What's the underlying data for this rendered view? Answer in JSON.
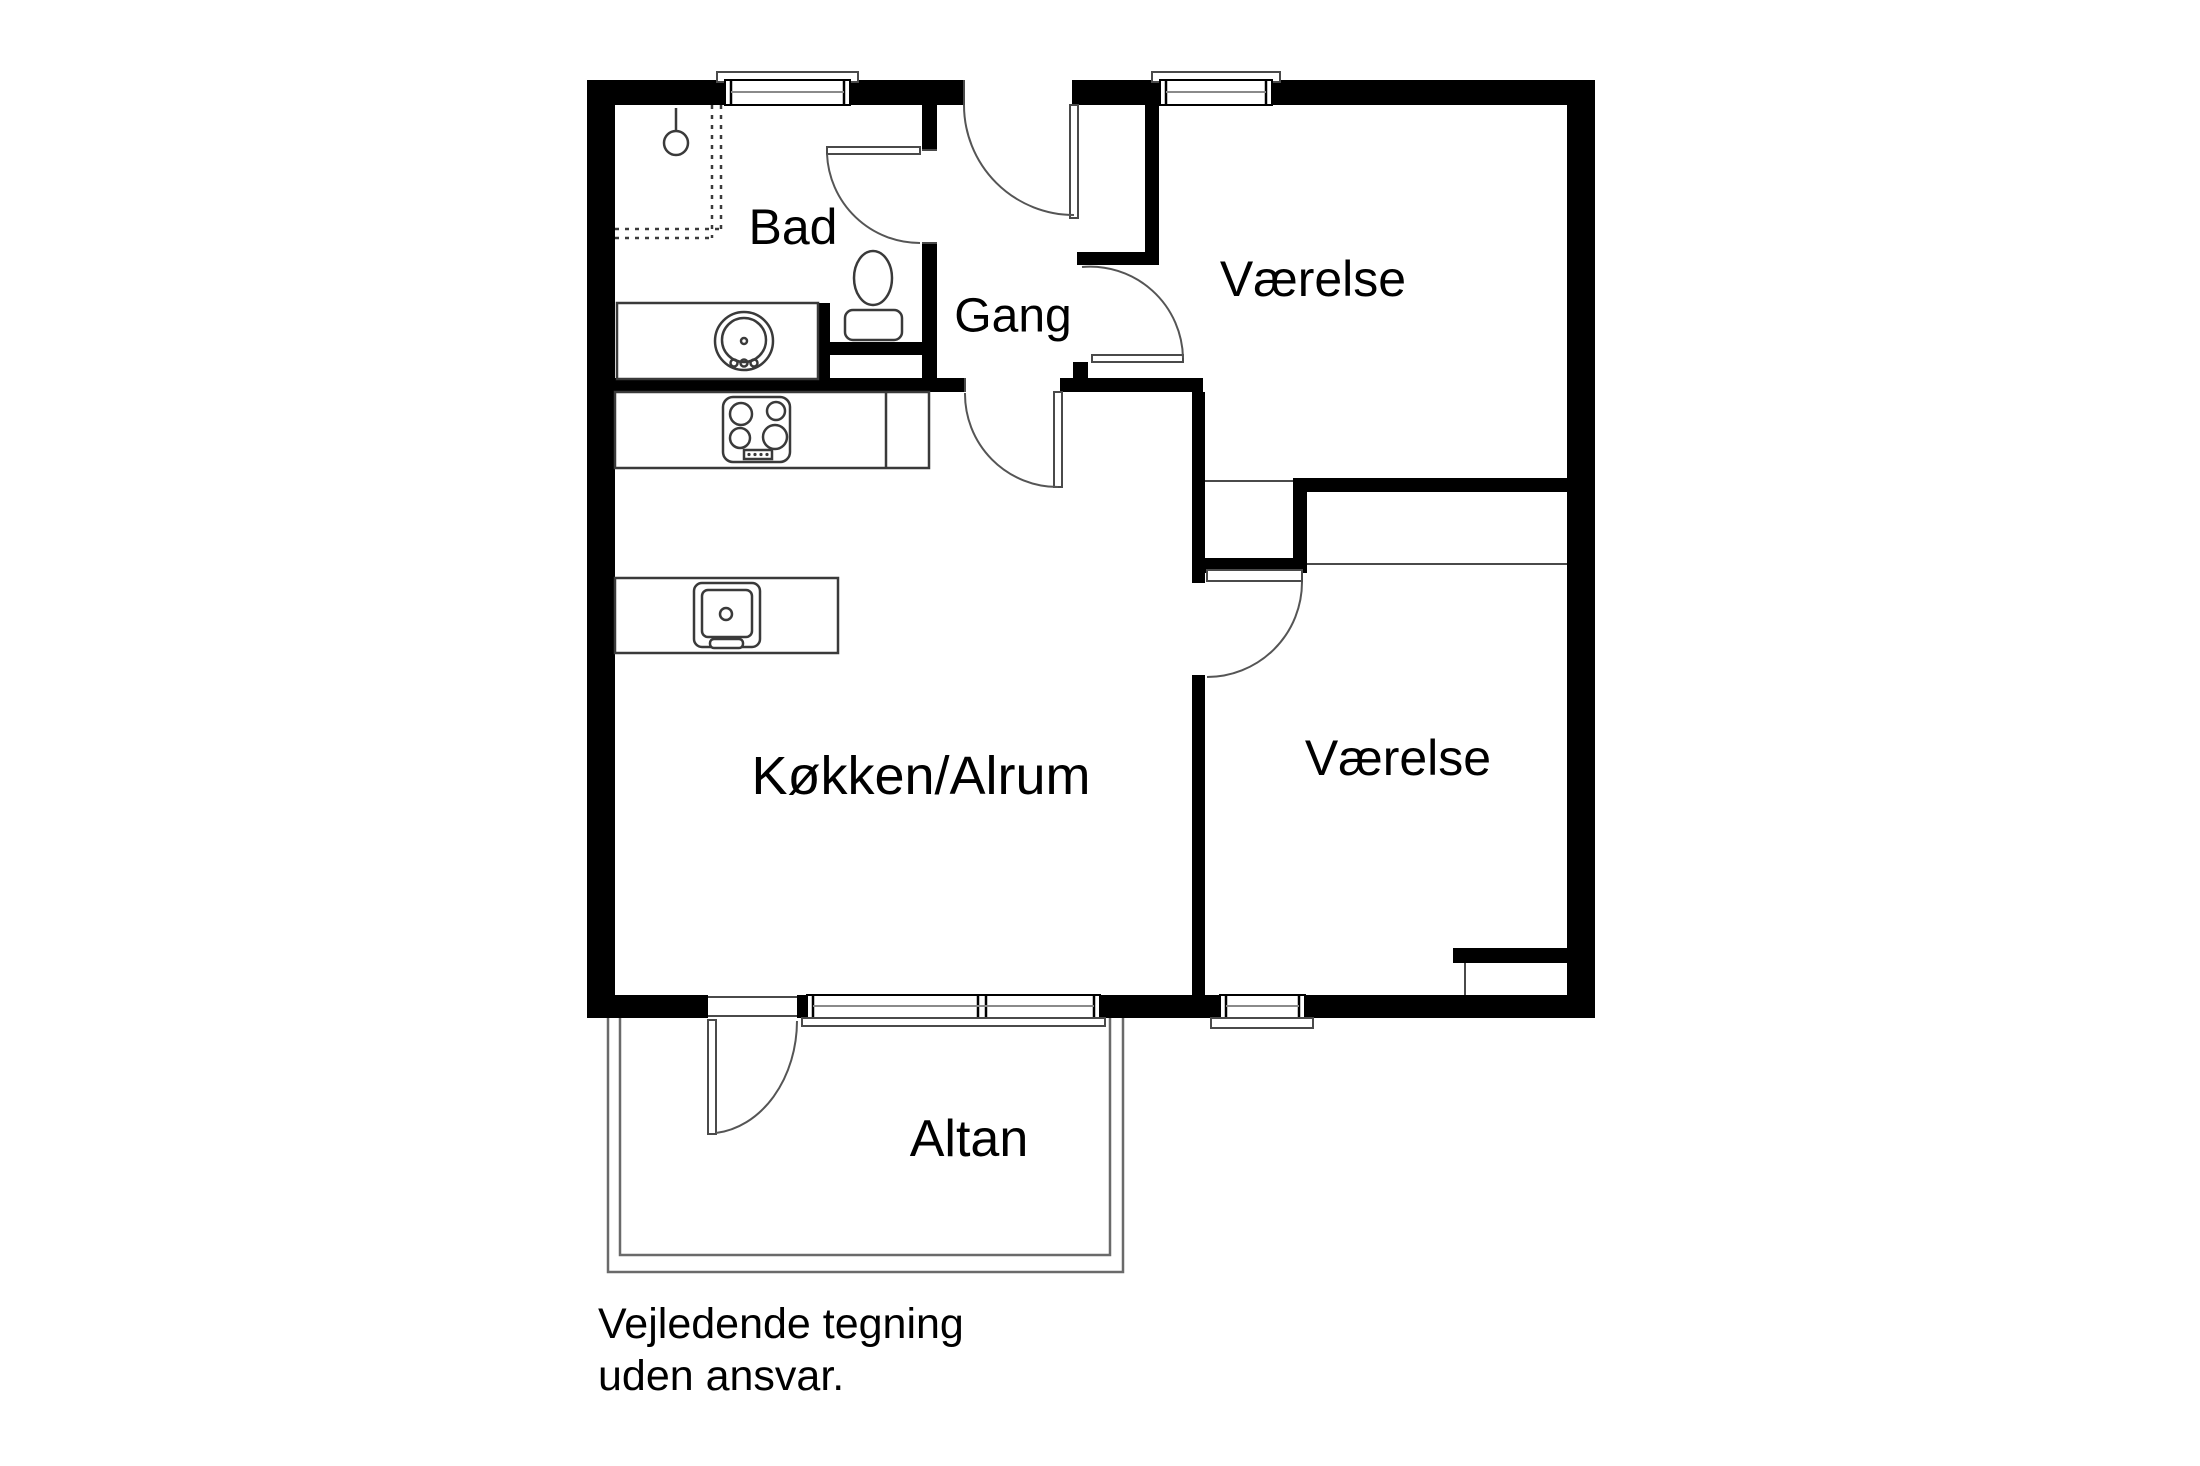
{
  "floorplan": {
    "rooms": [
      {
        "id": "bad",
        "label": "Bad"
      },
      {
        "id": "gang",
        "label": "Gang"
      },
      {
        "id": "vaerelse-top",
        "label": "Værelse"
      },
      {
        "id": "koekken-alrum",
        "label": "Køkken/Alrum"
      },
      {
        "id": "vaerelse-bottom",
        "label": "Værelse"
      },
      {
        "id": "altan",
        "label": "Altan"
      }
    ],
    "disclaimer": {
      "line1": "Vejledende tegning",
      "line2": "uden ansvar."
    },
    "symbols": [
      "shower-icon",
      "shower-zone-dotted",
      "bathroom-sink-icon",
      "toilet-icon",
      "cooktop-icon",
      "kitchen-island-sink-icon",
      "door-swing-arc",
      "window",
      "balcony-railing"
    ],
    "colors": {
      "wall": "#000000",
      "background": "#ffffff",
      "fixture_line": "#3a3a3a",
      "text": "#000000"
    }
  }
}
